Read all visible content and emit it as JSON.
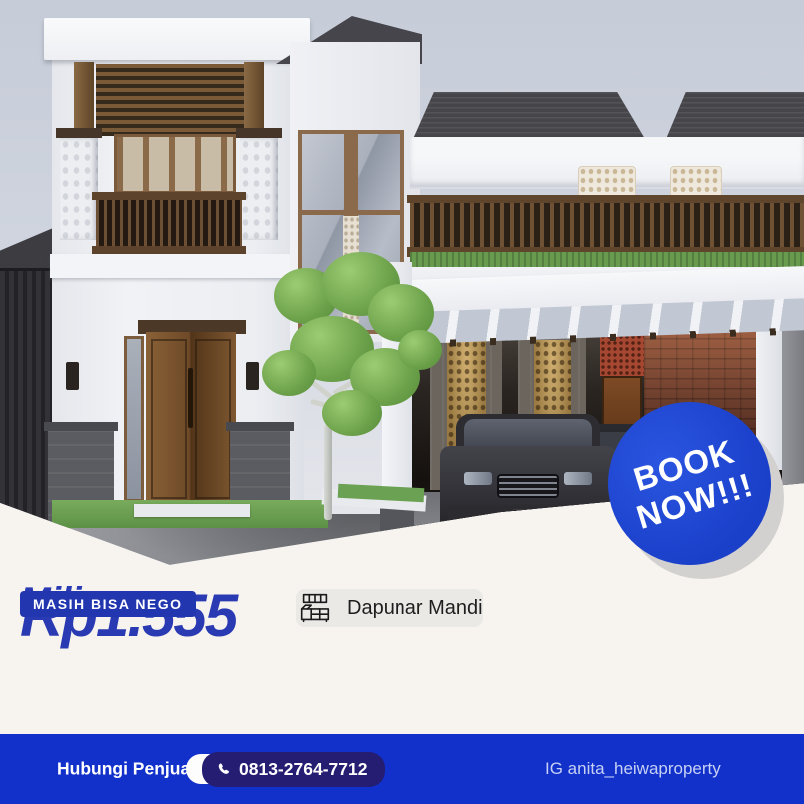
{
  "cta_badge": {
    "line1": "BOOK",
    "line2": "NOW!!!"
  },
  "price": {
    "amount": "Rp1.555",
    "unit": "Miliar",
    "nego": "MASIH BISA NEGO"
  },
  "features": [
    {
      "icon": "bed-icon",
      "label": "3 Kamar Tidur"
    },
    {
      "icon": "certificate-icon",
      "label": "Legalitas SHM"
    },
    {
      "icon": "shower-icon",
      "label": "3 Kamar Mandi"
    },
    {
      "icon": "kitchen-icon",
      "label": "Dapur"
    }
  ],
  "contact": {
    "heading": "Hubungi Penjual",
    "phone": "0813-2764-7712",
    "agent": "Anita Sari",
    "instagram": "IG anita_heiwaproperty"
  },
  "colors": {
    "bar_blue": "#1231cb",
    "price_blue": "#2a3ab2",
    "badge_blue": "#1a3fc9",
    "navy_pill": "#241d72",
    "card_bg": "#ebe9e6"
  }
}
